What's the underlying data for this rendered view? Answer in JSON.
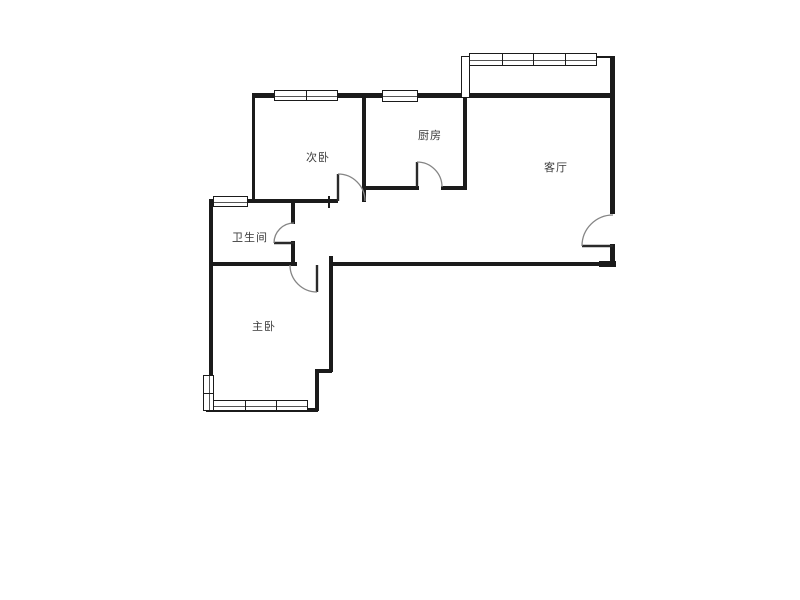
{
  "canvas": {
    "width": 800,
    "height": 600,
    "background": "#ffffff"
  },
  "colors": {
    "wall": "#1b1b1b",
    "door_arc": "#858585",
    "door_leaf": "#2a2a2a",
    "label": "#3a3a3a",
    "window_border": "#1b1b1b",
    "window_fill": "#ffffff"
  },
  "floorplan": {
    "rooms": [
      {
        "id": "secondary-bedroom",
        "label": "次卧",
        "x": 318,
        "y": 157
      },
      {
        "id": "kitchen",
        "label": "厨房",
        "x": 430,
        "y": 135
      },
      {
        "id": "living-room",
        "label": "客厅",
        "x": 556,
        "y": 167
      },
      {
        "id": "bathroom",
        "label": "卫生间",
        "x": 250,
        "y": 237
      },
      {
        "id": "master-bedroom",
        "label": "主卧",
        "x": 264,
        "y": 326
      }
    ],
    "walls": [
      {
        "x": 252,
        "y": 93,
        "w": 363,
        "h": 5
      },
      {
        "x": 597,
        "y": 56,
        "w": 16,
        "h": 2
      },
      {
        "x": 610,
        "y": 56,
        "w": 5,
        "h": 158
      },
      {
        "x": 610,
        "y": 244,
        "w": 5,
        "h": 21
      },
      {
        "x": 252,
        "y": 95,
        "w": 3,
        "h": 107
      },
      {
        "x": 362,
        "y": 95,
        "w": 4,
        "h": 107
      },
      {
        "x": 463,
        "y": 95,
        "w": 4,
        "h": 95
      },
      {
        "x": 364,
        "y": 186,
        "w": 55,
        "h": 4
      },
      {
        "x": 441,
        "y": 186,
        "w": 26,
        "h": 4
      },
      {
        "x": 209,
        "y": 199,
        "w": 129,
        "h": 4
      },
      {
        "x": 328,
        "y": 196,
        "w": 2,
        "h": 12
      },
      {
        "x": 209,
        "y": 199,
        "w": 4,
        "h": 178
      },
      {
        "x": 209,
        "y": 262,
        "w": 88,
        "h": 4
      },
      {
        "x": 291,
        "y": 199,
        "w": 4,
        "h": 25
      },
      {
        "x": 291,
        "y": 241,
        "w": 4,
        "h": 25
      },
      {
        "x": 329,
        "y": 256,
        "w": 4,
        "h": 116
      },
      {
        "x": 330,
        "y": 262,
        "w": 286,
        "h": 4
      },
      {
        "x": 599,
        "y": 261,
        "w": 17,
        "h": 6
      },
      {
        "x": 316,
        "y": 369,
        "w": 16,
        "h": 4
      },
      {
        "x": 315,
        "y": 369,
        "w": 4,
        "h": 42
      },
      {
        "x": 206,
        "y": 408,
        "w": 112,
        "h": 4
      }
    ],
    "windows": [
      {
        "id": "secondary-bedroom-window",
        "x": 274,
        "y": 90,
        "w": 64,
        "h": 11,
        "orient": "h",
        "panes": 2,
        "mid": true
      },
      {
        "id": "kitchen-window",
        "x": 382,
        "y": 90,
        "w": 36,
        "h": 12,
        "orient": "h",
        "panes": 1,
        "mid": true
      },
      {
        "id": "balcony-window",
        "x": 469,
        "y": 53,
        "w": 128,
        "h": 13,
        "orient": "h",
        "panes": 4,
        "mid": true
      },
      {
        "id": "balcony-side-panel",
        "x": 461,
        "y": 56,
        "w": 9,
        "h": 42,
        "orient": "v",
        "panes": 1,
        "mid": false
      },
      {
        "id": "bathroom-window",
        "x": 213,
        "y": 196,
        "w": 35,
        "h": 11,
        "orient": "h",
        "panes": 1,
        "mid": true
      },
      {
        "id": "master-bedroom-side-window",
        "x": 203,
        "y": 375,
        "w": 11,
        "h": 36,
        "orient": "v",
        "panes": 2,
        "mid": true
      },
      {
        "id": "master-bedroom-bottom-window",
        "x": 213,
        "y": 400,
        "w": 95,
        "h": 11,
        "orient": "h",
        "panes": 3,
        "mid": true
      }
    ],
    "doors": [
      {
        "id": "secondary-bedroom-door",
        "hinge": [
          338,
          201
        ],
        "tip": [
          338,
          174
        ],
        "end": [
          365,
          201
        ],
        "radius": 27
      },
      {
        "id": "kitchen-door",
        "hinge": [
          417,
          187
        ],
        "tip": [
          417,
          162
        ],
        "end": [
          442,
          187
        ],
        "radius": 25
      },
      {
        "id": "bathroom-door",
        "hinge": [
          294,
          243
        ],
        "tip": [
          274,
          243
        ],
        "end": [
          294,
          223
        ],
        "radius": 20
      },
      {
        "id": "master-bedroom-door",
        "hinge": [
          317,
          265
        ],
        "tip": [
          317,
          292
        ],
        "end": [
          290,
          265
        ],
        "radius": 27
      },
      {
        "id": "entrance-door",
        "hinge": [
          613,
          246
        ],
        "tip": [
          582,
          246
        ],
        "end": [
          613,
          215
        ],
        "radius": 31
      }
    ]
  }
}
